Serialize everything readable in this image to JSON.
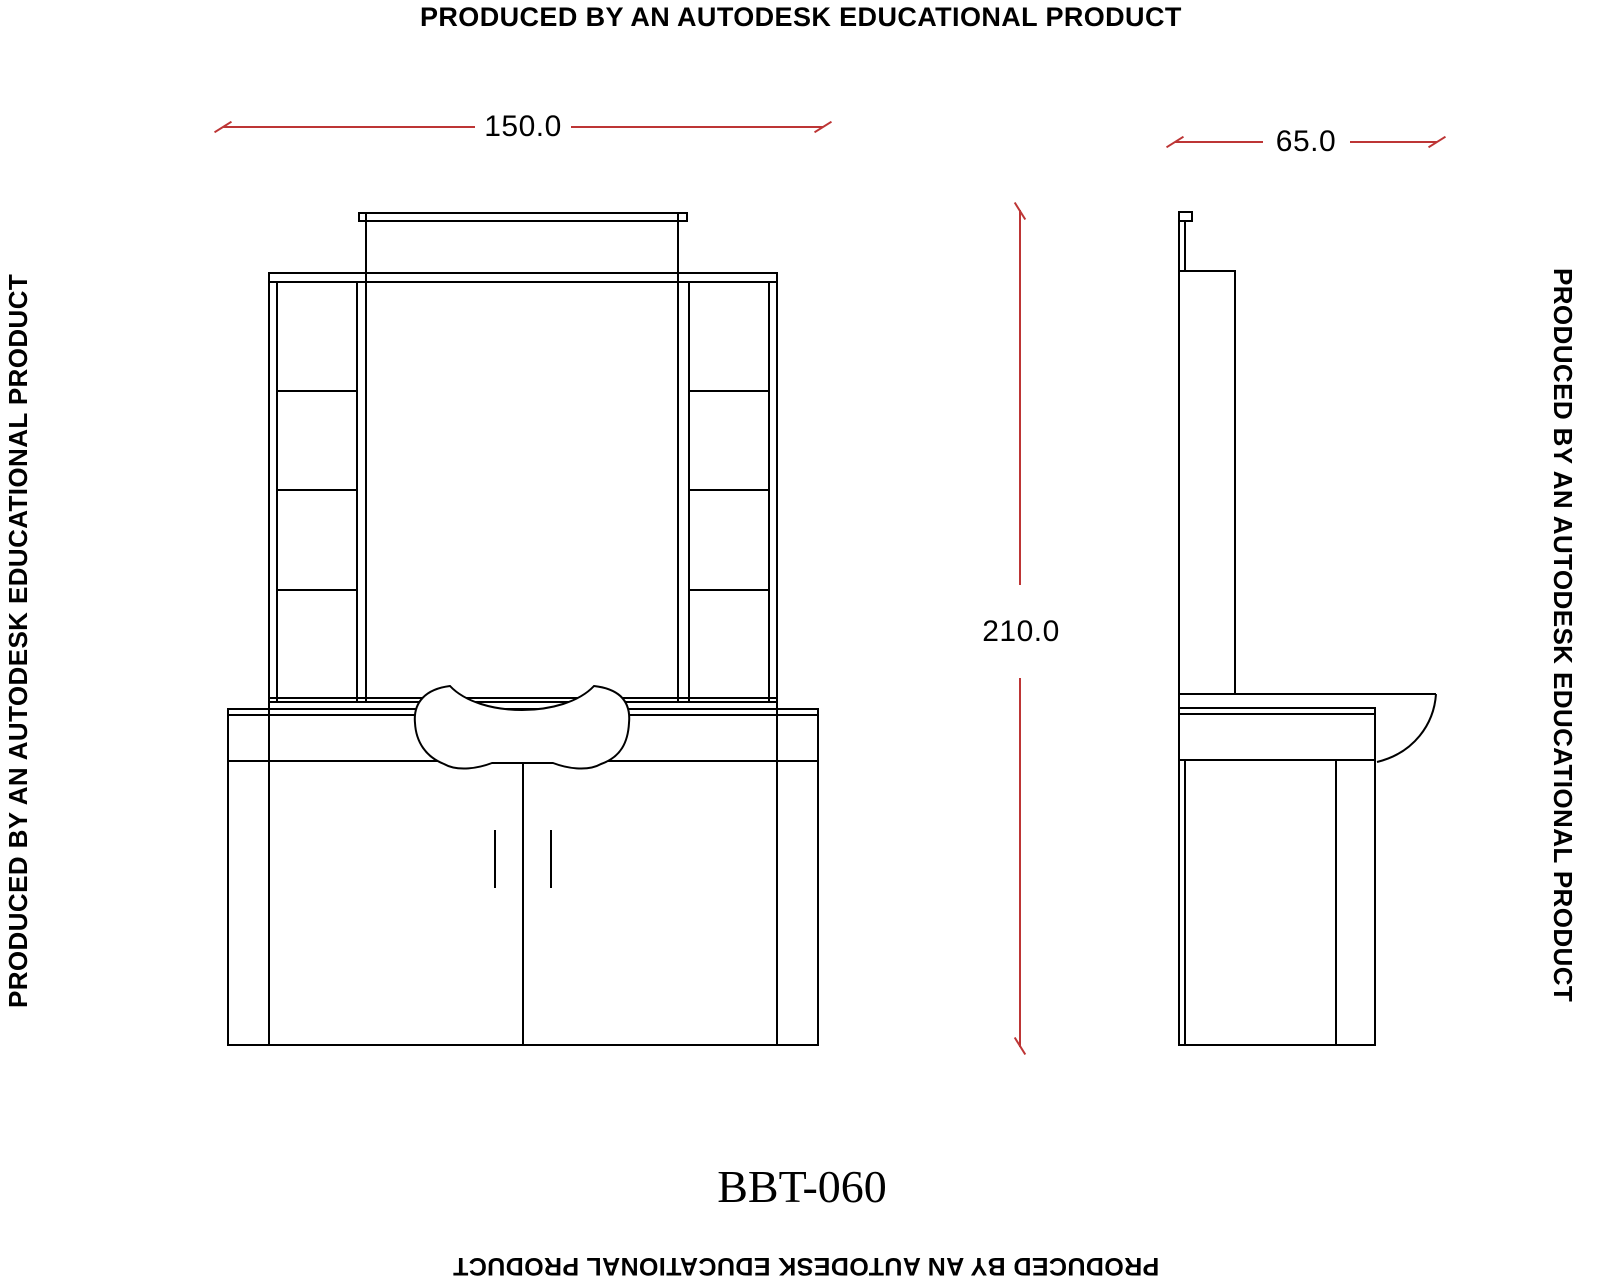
{
  "watermark": {
    "text": "PRODUCED BY AN AUTODESK EDUCATIONAL PRODUCT"
  },
  "title_block": {
    "model_number": "BBT-060"
  },
  "dimensions": {
    "front_width": "150.0",
    "side_depth": "65.0",
    "overall_height": "210.0"
  },
  "colors": {
    "drawing_line": "#000000",
    "dimension_line": "#bd3535",
    "background": "#ffffff"
  }
}
